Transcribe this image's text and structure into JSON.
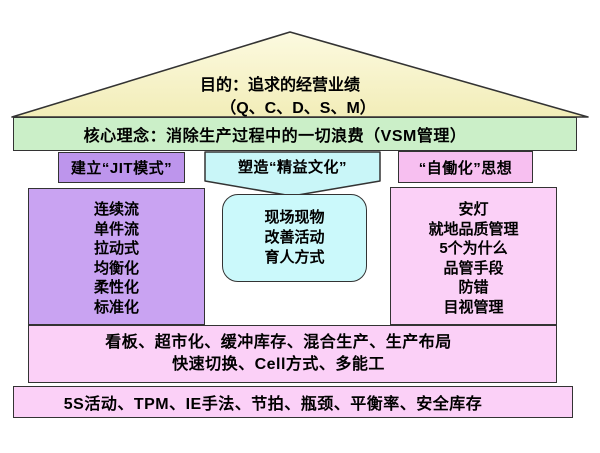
{
  "roof": {
    "line1": "目的：追求的经营业绩",
    "line2": "（Q、C、D、S、M）"
  },
  "core_band": "核心理念：消除生产过程中的一切浪费（VSM管理）",
  "pillars": [
    {
      "header": "建立“JIT模式”",
      "items": [
        "连续流",
        "单件流",
        "拉动式",
        "均衡化",
        "柔性化",
        "标准化"
      ]
    },
    {
      "header": "塑造“精益文化”",
      "items": [
        "现场现物",
        "改善活动",
        "育人方式"
      ]
    },
    {
      "header": "“自働化”思想",
      "items": [
        "安灯",
        "就地品质管理",
        "5个为什么",
        "品管手段",
        "防错",
        "目视管理"
      ]
    }
  ],
  "foundation": {
    "row1": {
      "line1": "看板、超市化、缓冲库存、混合生产、生产布局",
      "line2": "快速切换、Cell方式、多能工"
    },
    "row2": {
      "line1": "5S活动、TPM、IE手法、节拍、瓶颈、平衡率、安全库存"
    }
  },
  "colors": {
    "roof_fill_top": "#FCFAE0",
    "roof_fill_bottom": "#F2EDB8",
    "core_band_fill": "#CBEFC8",
    "jit_header_fill": "#BD95EC",
    "jit_column_fill": "#C9A3F2",
    "lean_header_fill": "#C9F6F8",
    "lean_box_fill": "#CBF9FB",
    "jidoka_header_fill": "#F7BFF0",
    "jidoka_column_fill": "#FBD0F7",
    "foundation_fill": "#FBD0F7",
    "outline": "#333333"
  }
}
